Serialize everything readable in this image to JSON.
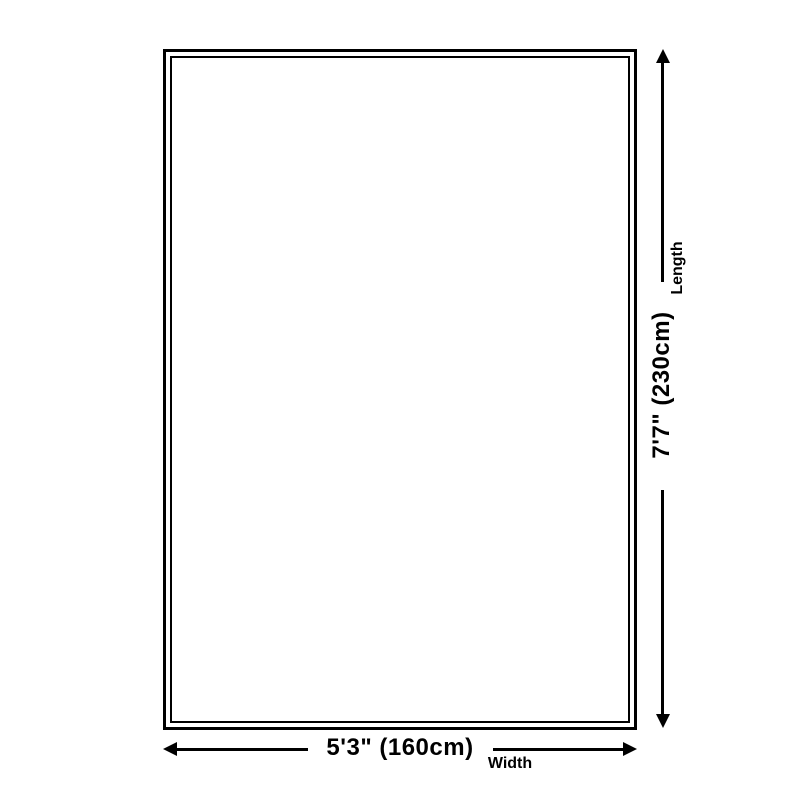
{
  "diagram": {
    "length": {
      "label": "Length",
      "value": "7'7\" (230cm)"
    },
    "width": {
      "label": "Width",
      "value": "5'3\" (160cm)"
    }
  },
  "colors": {
    "line": "#000000",
    "background": "#ffffff"
  }
}
